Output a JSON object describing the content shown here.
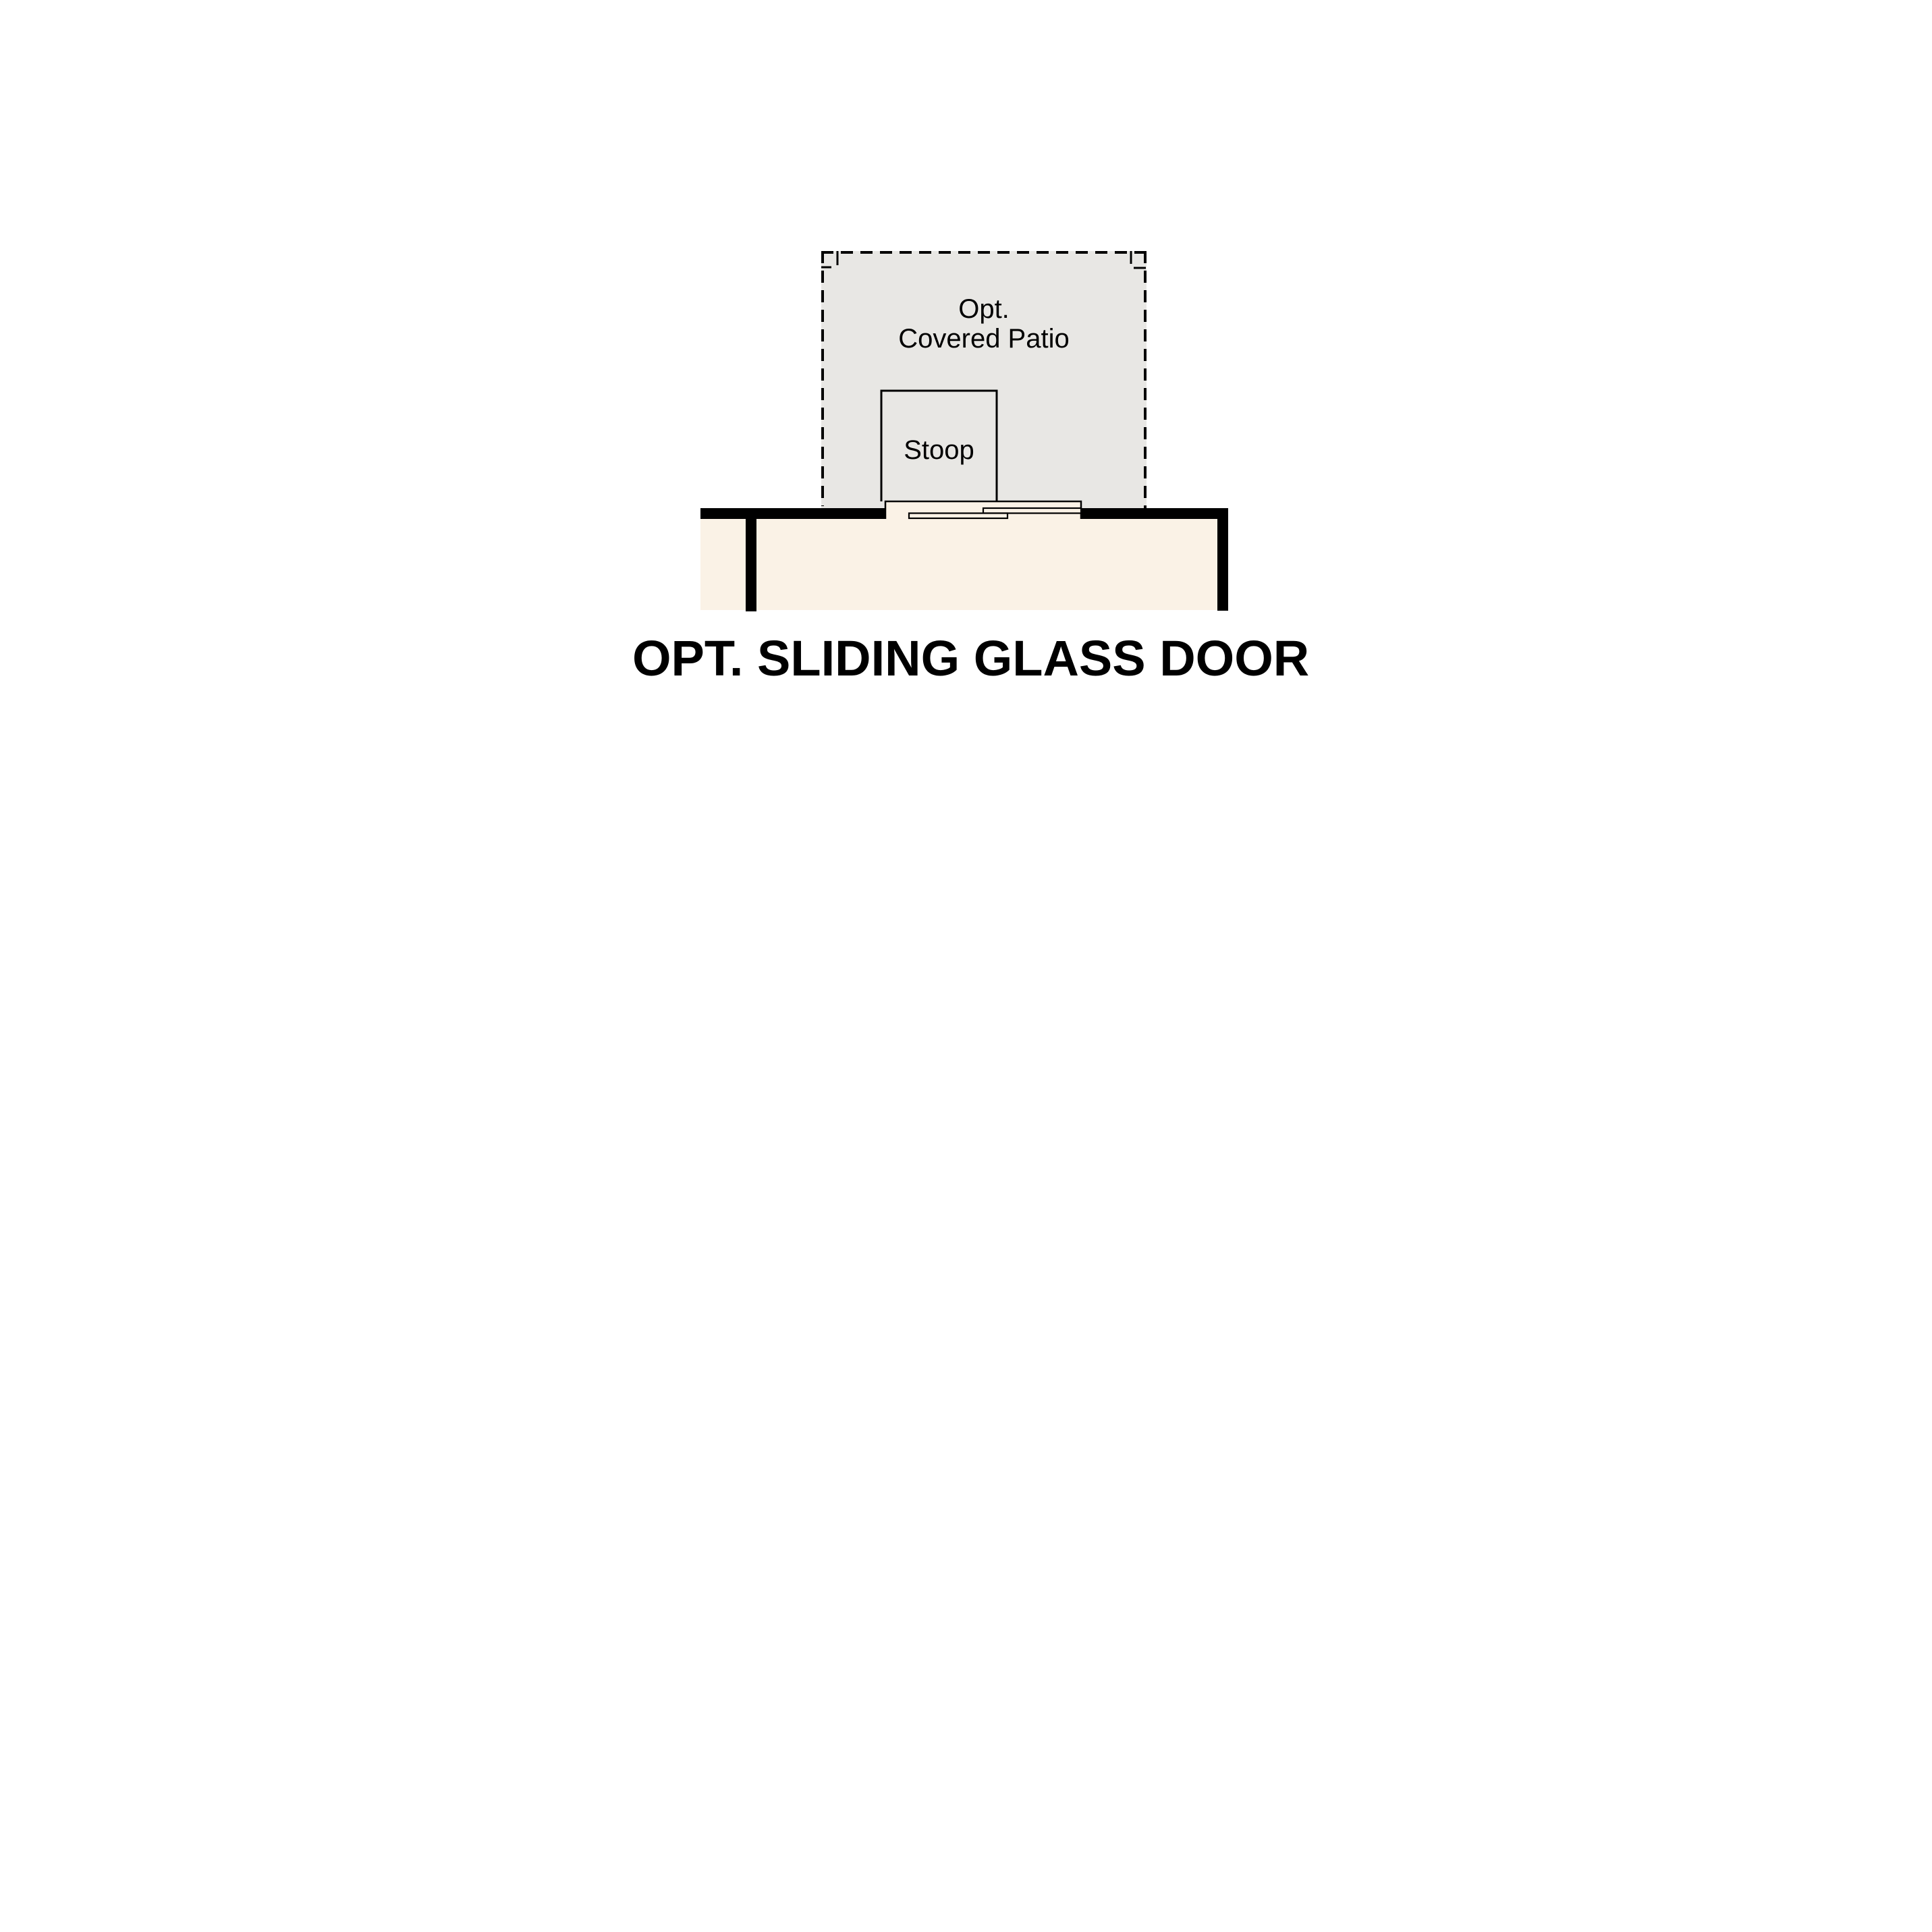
{
  "figure": {
    "caption": "OPT. SLIDING GLASS DOOR",
    "areas": {
      "patio": {
        "label_line1": "Opt.",
        "label_line2": "Covered Patio"
      },
      "stoop": {
        "label": "Stoop"
      }
    },
    "colors": {
      "patio_fill": "#e8e7e4",
      "floor_fill": "#faf2e6",
      "wall": "#000000",
      "line": "#000000",
      "background": "#ffffff"
    }
  }
}
